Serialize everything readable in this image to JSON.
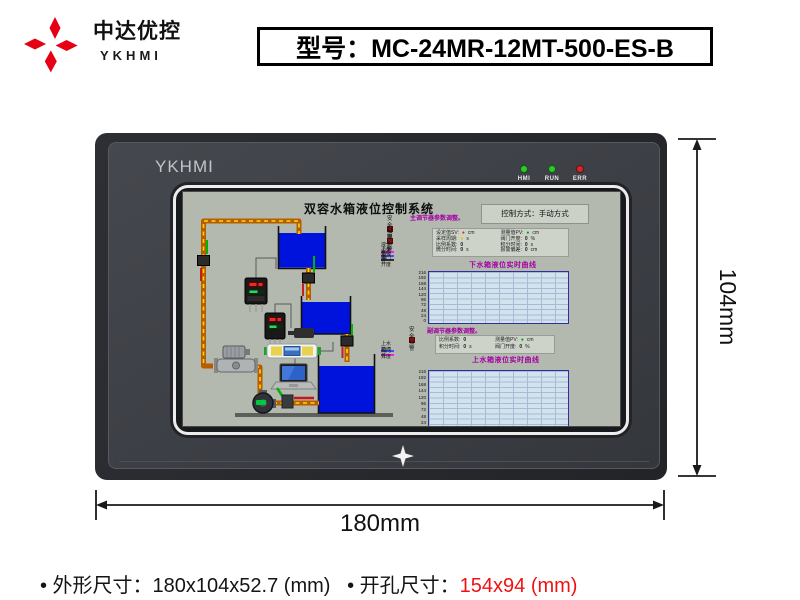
{
  "brand": {
    "company_cn": "中达优控",
    "company_en": "YKHMI"
  },
  "model_box": {
    "label": "型号：MC-24MR-12MT-500-ES-B"
  },
  "device": {
    "bezel_brand": "YKHMI",
    "leds": [
      {
        "label": "HMI",
        "color": "#2ec82e"
      },
      {
        "label": "RUN",
        "color": "#2ec82e"
      },
      {
        "label": "ERR",
        "color": "#d22828"
      }
    ]
  },
  "screen": {
    "title": "双容水箱液位控制系统",
    "control_mode": "控制方式：手动方式",
    "main_regulator_title": "主调节器参数调整。",
    "sub_regulator_title": "副调节器参数调整。",
    "alarms_top": [
      "安全报警",
      "越限报警"
    ],
    "alarm_mid": "安全报警",
    "legend1": [
      {
        "color": "#ee22ee",
        "label": "液位设定值"
      },
      {
        "color": "#3c50ff",
        "label": "下水箱液位"
      },
      {
        "color": "#303030",
        "label": "电动阀门开度"
      }
    ],
    "legend2": [
      {
        "color": "#3c50ff",
        "label": "上水箱液位"
      },
      {
        "color": "#ee22ee",
        "label": "阀门开度"
      }
    ],
    "params1_left": [
      {
        "label": "设定值SV:",
        "value": "●",
        "fg": "#e03000",
        "unit": "cm"
      },
      {
        "label": "采样周期:",
        "value": "●",
        "fg": "#ddc800",
        "unit": "s"
      },
      {
        "label": "比例系数:",
        "value": "0",
        "fg": "#202020",
        "unit": ""
      },
      {
        "label": "微分时间:",
        "value": "0",
        "fg": "#202020",
        "unit": "s"
      }
    ],
    "params1_right": [
      {
        "label": "测量值PV:",
        "value": "●",
        "fg": "#00a000",
        "unit": "cm"
      },
      {
        "label": "阀门开度:",
        "value": "0",
        "fg": "#202020",
        "unit": "%"
      },
      {
        "label": "积分时间:",
        "value": "0",
        "fg": "#202020",
        "unit": "s"
      },
      {
        "label": "报警偏差:",
        "value": "0",
        "fg": "#202020",
        "unit": "cm"
      }
    ],
    "params2_left": [
      {
        "label": "比例系数:",
        "value": "0",
        "fg": "#202020",
        "unit": ""
      },
      {
        "label": "积分时间:",
        "value": "0",
        "fg": "#202020",
        "unit": "s"
      }
    ],
    "params2_right": [
      {
        "label": "测量值PV:",
        "value": "●",
        "fg": "#00a000",
        "unit": "cm"
      },
      {
        "label": "阀门开度:",
        "value": "0",
        "fg": "#202020",
        "unit": "%"
      }
    ],
    "chart1": {
      "title": "下水箱液位实时曲线",
      "yticks": [
        "216",
        "192",
        "168",
        "144",
        "120",
        "96",
        "72",
        "48",
        "24",
        "0"
      ]
    },
    "chart2": {
      "title": "上水箱液位实时曲线",
      "yticks": [
        "216",
        "192",
        "168",
        "144",
        "120",
        "96",
        "72",
        "48",
        "24",
        "0"
      ]
    }
  },
  "chart_data": [
    {
      "type": "line",
      "title": "下水箱液位实时曲线",
      "xlabel": "",
      "ylabel": "",
      "ylim": [
        0,
        216
      ],
      "yticks": [
        216,
        192,
        168,
        144,
        120,
        96,
        72,
        48,
        24,
        0
      ],
      "grid": true,
      "series": []
    },
    {
      "type": "line",
      "title": "上水箱液位实时曲线",
      "xlabel": "",
      "ylabel": "",
      "ylim": [
        0,
        216
      ],
      "yticks": [
        216,
        192,
        168,
        144,
        120,
        96,
        72,
        48,
        24,
        0
      ],
      "grid": true,
      "series": []
    }
  ],
  "dimensions": {
    "height_label": "104mm",
    "width_label": "180mm"
  },
  "specs": {
    "segments": [
      {
        "text": "• 外形尺寸：180x104x52.7 (mm)",
        "color": "#141414"
      },
      {
        "text": "   • 开孔尺寸：",
        "color": "#141414"
      },
      {
        "text": "154x94 (mm)",
        "color": "#f21111"
      }
    ]
  },
  "colors": {
    "brand": "#e60013",
    "water": "#0013dd",
    "pipe": "#b85c00",
    "pipe_dash": "#ffd900",
    "screen_bg": "#b3b9af",
    "chart_bg": "#d2e2ee",
    "chart_grid": "#a6bcd2",
    "chart_border": "#2e2e9e",
    "purple": "#a400a4",
    "alarm_red": "#cc1212"
  }
}
